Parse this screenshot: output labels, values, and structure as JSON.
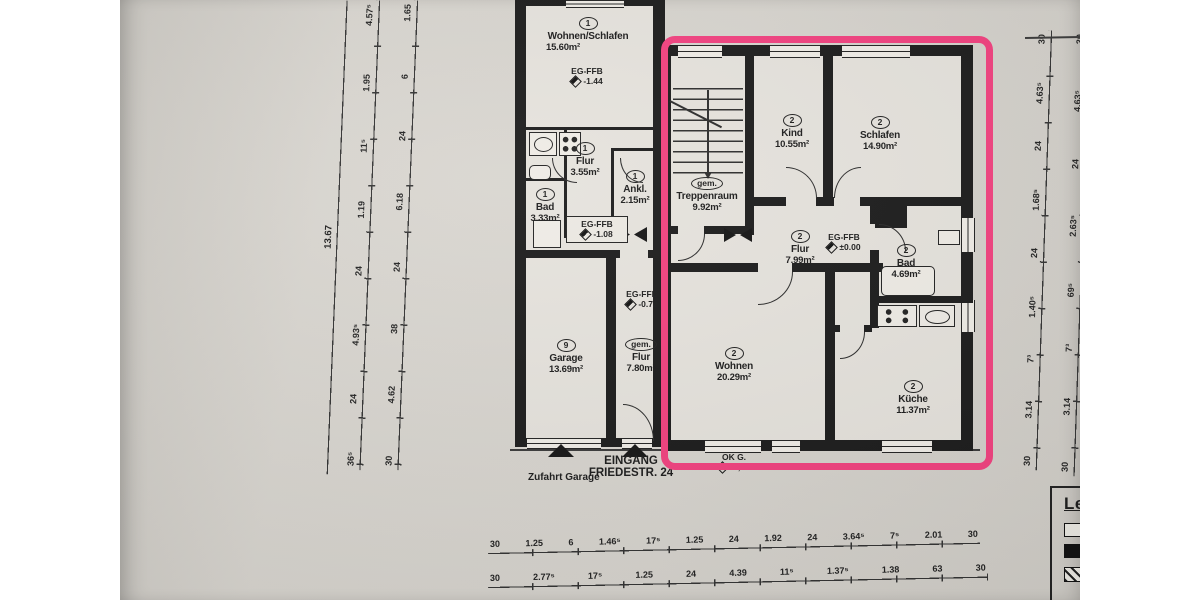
{
  "scan": {
    "paper_color": "#d7d4ce",
    "ink_color": "#1b1b1b",
    "highlight_color": "#f2417f"
  },
  "rooms": {
    "wohnen_schlafen": {
      "num": "1",
      "name": "Wohnen/Schlafen",
      "area": "15.60m²"
    },
    "flur1": {
      "num": "1",
      "name": "Flur",
      "area": "3.55m²"
    },
    "ankl": {
      "num": "1",
      "name": "Ankl.",
      "area": "2.15m²"
    },
    "bad1": {
      "num": "1",
      "name": "Bad",
      "area": "3.33m²"
    },
    "garage": {
      "num": "9",
      "name": "Garage",
      "area": "13.69m²"
    },
    "gem_flur": {
      "num": "gem.",
      "name": "Flur",
      "area": "7.80m²"
    },
    "treppenraum": {
      "num": "gem.",
      "name": "Treppenraum",
      "area": "9.92m²"
    },
    "kind": {
      "num": "2",
      "name": "Kind",
      "area": "10.55m²"
    },
    "schlafen": {
      "num": "2",
      "name": "Schlafen",
      "area": "14.90m²"
    },
    "flur2": {
      "num": "2",
      "name": "Flur",
      "area": "7.99m²"
    },
    "bad2": {
      "num": "2",
      "name": "Bad",
      "area": "4.69m²"
    },
    "wohnen2": {
      "num": "2",
      "name": "Wohnen",
      "area": "20.29m²"
    },
    "kueche": {
      "num": "2",
      "name": "Küche",
      "area": "11.37m²"
    }
  },
  "levels": {
    "ffb_top": {
      "label": "EG-FFB",
      "value": "-1.44"
    },
    "ffb_mid": {
      "label": "EG-FFB",
      "value": "-1.08"
    },
    "ffb_corridor": {
      "label": "EG-FFB",
      "value": "-0.72"
    },
    "ffb_apartment": {
      "label": "EG-FFB",
      "value": "±0.00"
    },
    "ok_g": {
      "label": "OK G.",
      "value": "-0,80"
    }
  },
  "annotations": {
    "zufahrt_garage": "Zufahrt Garage",
    "eingang_line1": "EINGANG",
    "eingang_line2": "FRIEDESTR. 24"
  },
  "legend": {
    "title": "Legende :",
    "bestand_label": "MW Bestand",
    "neu_label": "MW Neu / Ersatz"
  },
  "dimensions": {
    "left_total": "13.67",
    "left_chain_a": [
      "4.57⁵",
      "1.95",
      "11⁵",
      "1.19",
      "24",
      "4.93⁵",
      "24",
      "36⁵"
    ],
    "left_chain_b": [
      "1.65",
      "6",
      "24",
      "6.18",
      "24",
      "38",
      "4.62",
      "30"
    ],
    "right_chain_a": [
      "30",
      "4.63⁵",
      "24",
      "1.68⁵",
      "24",
      "1.40⁵",
      "7³",
      "3.14",
      "30"
    ],
    "right_chain_b": [
      "30",
      "4.63⁵",
      "24",
      "2.63⁵",
      "69⁵",
      "7³",
      "3.14",
      "30"
    ],
    "right_total": "12.02",
    "bottom_row1": [
      "30",
      "1.25",
      "6",
      "1.46⁵",
      "17⁵",
      "1.25",
      "24",
      "1.92",
      "24",
      "3.64⁵",
      "7⁵",
      "2.01",
      "30"
    ],
    "bottom_row2": [
      "30",
      "2.77⁵",
      "17⁵",
      "1.25",
      "24",
      "4.39",
      "11⁵",
      "1.37⁵",
      "1.38",
      "63",
      "30"
    ]
  }
}
